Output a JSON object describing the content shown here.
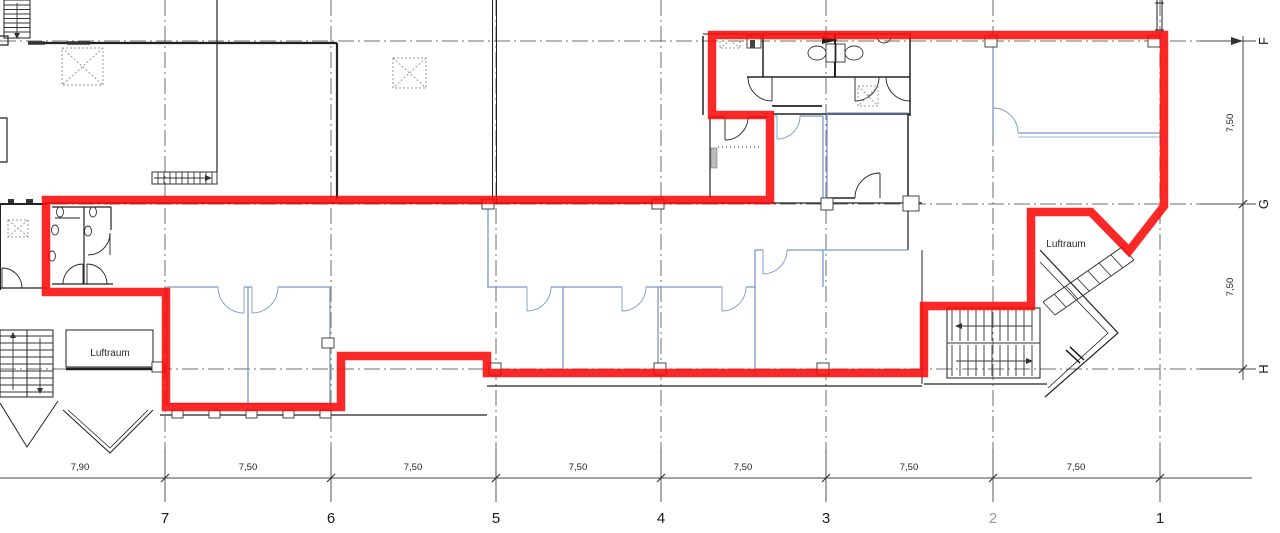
{
  "grid": {
    "columns": [
      {
        "label": "7"
      },
      {
        "label": "6"
      },
      {
        "label": "5"
      },
      {
        "label": "4"
      },
      {
        "label": "3"
      },
      {
        "label": "2"
      },
      {
        "label": "1"
      }
    ],
    "rows": [
      {
        "label": "F"
      },
      {
        "label": "G"
      },
      {
        "label": "H"
      }
    ]
  },
  "dimensions": {
    "bottom": [
      "7,90",
      "7,50",
      "7,50",
      "7,50",
      "7,50",
      "7,50",
      "7,50"
    ],
    "right": [
      "7,50",
      "7,50"
    ]
  },
  "labels": {
    "luftraum_left": "Luftraum",
    "luftraum_right": "Luftraum"
  },
  "colors": {
    "red_outline": "#fa0a0a",
    "wall_blue": "#7b97cc",
    "background": "#ffffff"
  }
}
